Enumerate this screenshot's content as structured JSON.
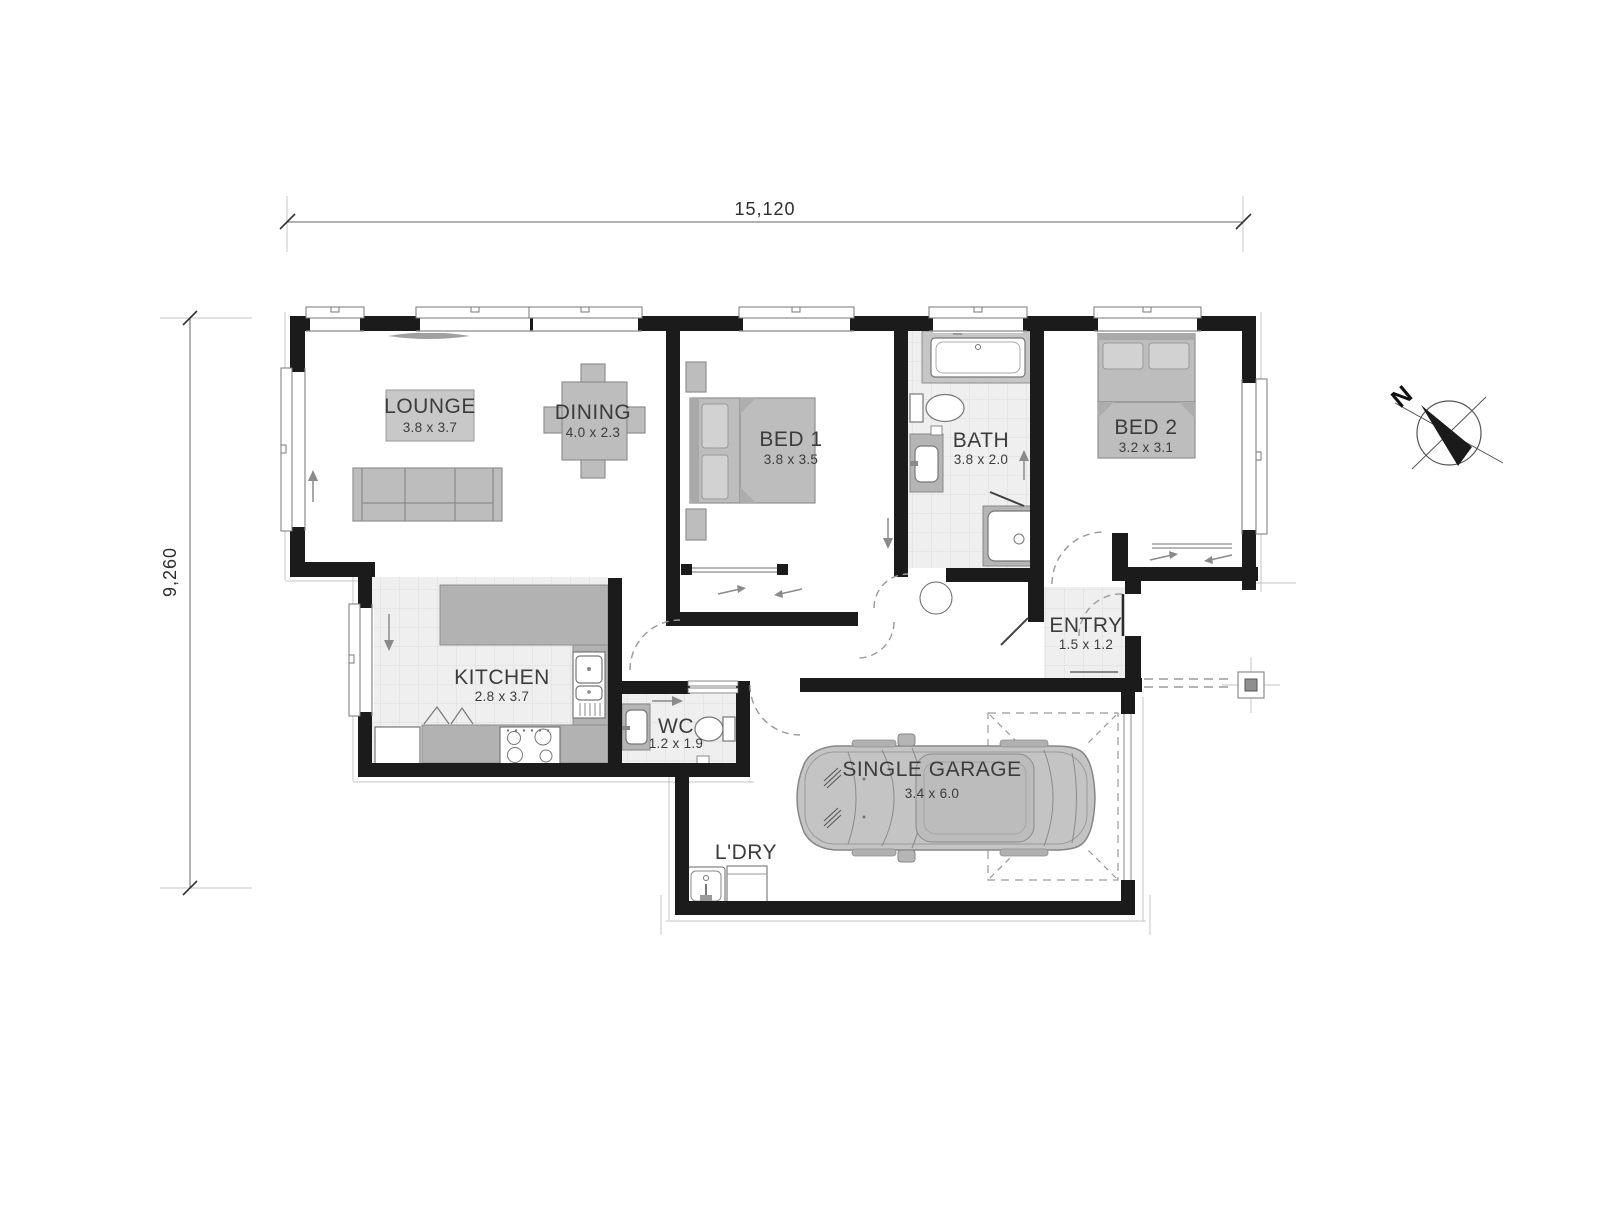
{
  "dimensions": {
    "overall_width": "15,120",
    "overall_depth": "9,260"
  },
  "compass": {
    "north_label": "N"
  },
  "rooms": {
    "lounge": {
      "name": "LOUNGE",
      "size": "3.8 x 3.7"
    },
    "dining": {
      "name": "DINING",
      "size": "4.0 x 2.3"
    },
    "bed1": {
      "name": "BED 1",
      "size": "3.8 x 3.5"
    },
    "bath": {
      "name": "BATH",
      "size": "3.8 x 2.0"
    },
    "bed2": {
      "name": "BED 2",
      "size": "3.2 x 3.1"
    },
    "kitchen": {
      "name": "KITCHEN",
      "size": "2.8 x 3.7"
    },
    "wc": {
      "name": "WC",
      "size": "1.2 x 1.9"
    },
    "entry": {
      "name": "ENTRY",
      "size": "1.5 x 1.2"
    },
    "garage": {
      "name": "SINGLE GARAGE",
      "size": "3.4 x 6.0"
    },
    "laundry": {
      "name": "L'DRY"
    }
  },
  "colors": {
    "wall": "#1b1b1b",
    "furniture": "#bdbdbd",
    "tile": "#efefef",
    "text": "#3c3c3c"
  }
}
